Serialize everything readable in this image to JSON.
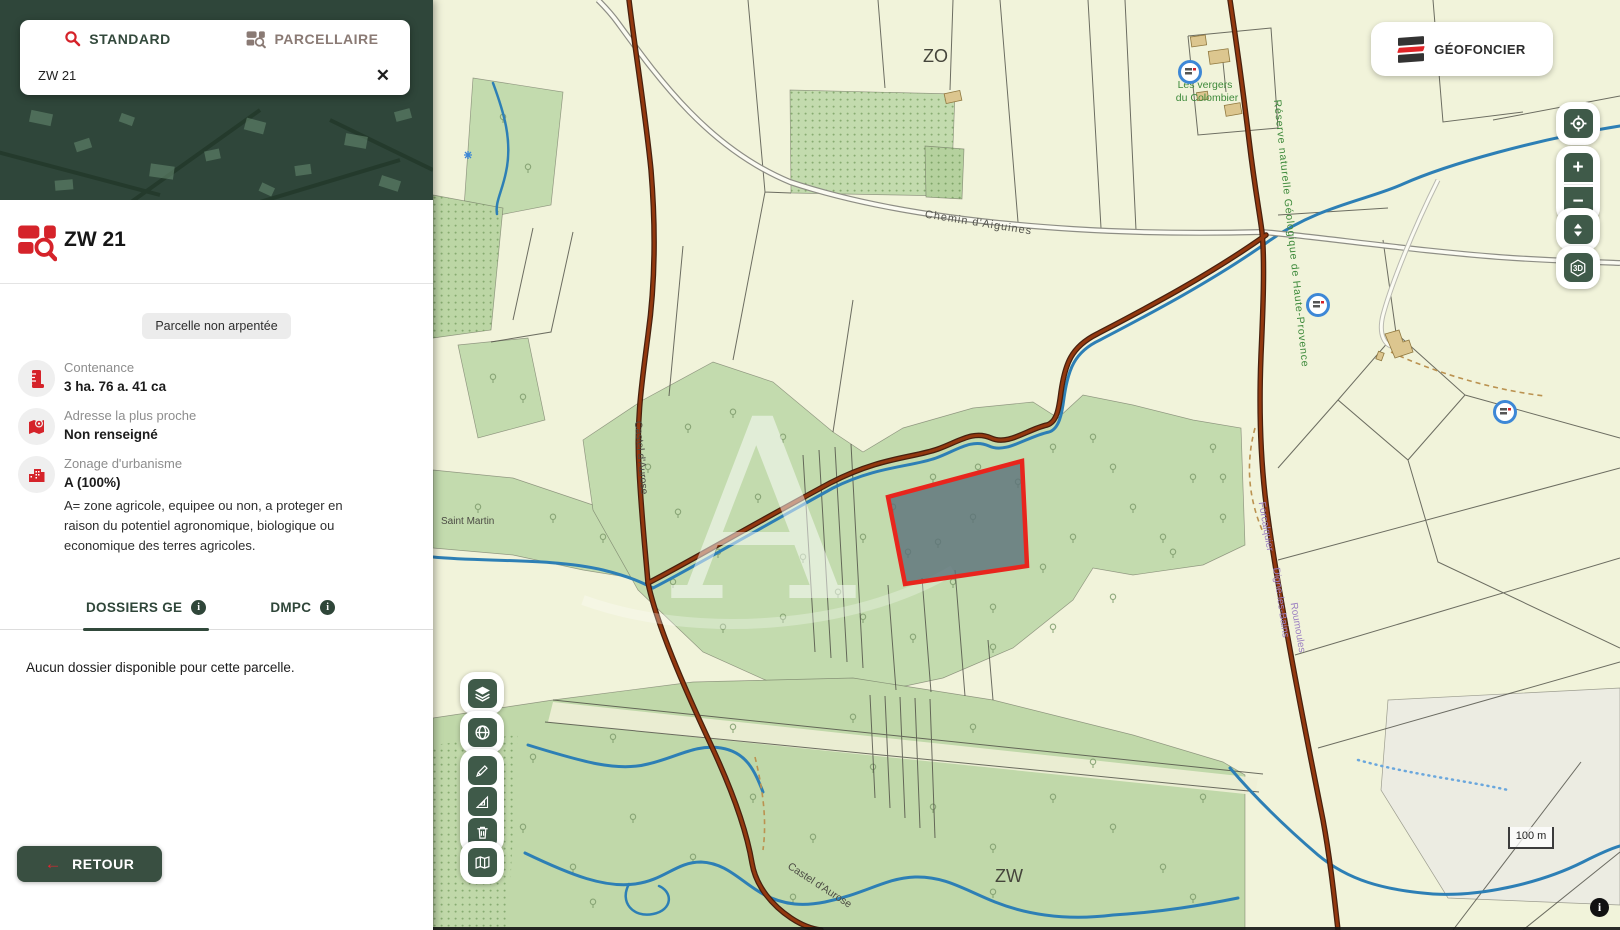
{
  "search": {
    "tabs": [
      {
        "label": "STANDARD"
      },
      {
        "label": "PARCELLAIRE"
      }
    ],
    "query": "ZW 21"
  },
  "brand": {
    "name": "GÉOFONCIER"
  },
  "parcel": {
    "title": "ZW 21",
    "badge": "Parcelle non arpentée",
    "fields": [
      {
        "icon": "ruler-icon",
        "label": "Contenance",
        "value": "3 ha. 76 a. 41 ca"
      },
      {
        "icon": "address-icon",
        "label": "Adresse la plus proche",
        "value": "Non renseigné"
      },
      {
        "icon": "urbanism-icon",
        "label": "Zonage d'urbanisme",
        "value": "A (100%)",
        "description": "A= zone agricole, equipee ou non, a proteger en raison du potentiel agronomique, biologique ou economique des terres agricoles."
      }
    ],
    "tabs": [
      {
        "label": "DOSSIERS GE"
      },
      {
        "label": "DMPC"
      }
    ],
    "tab_info_glyph": "i",
    "empty_message": "Aucun dossier disponible pour cette parcelle.",
    "back_label": "RETOUR",
    "back_arrow": "←"
  },
  "map": {
    "labels": {
      "zone_top": "ZO",
      "zone_bottom": "ZW",
      "road_chemin": "Chemin d'Aiguines",
      "road_castel_upper": "Castel d'Aurose",
      "road_castel_lower": "Castel d'Aurose",
      "hamlet": "Saint Martin",
      "place_line1": "Les vergers",
      "place_line2": "du Colombier",
      "reserve": "Réserve naturelle Géologique de Haute-Provence",
      "route_1": "Forcalquier",
      "route_2": "Digne-les-Bains",
      "route_3": "Roumoules",
      "watermark": "A"
    },
    "scale_label": "100 m",
    "controls": {
      "zoom_in": "+",
      "zoom_out": "−",
      "view_3d": "3D",
      "info": "i"
    }
  },
  "colors": {
    "accent_red": "#d5232a",
    "dark_green": "#394f41",
    "control_green": "#3f5a49",
    "map_background": "#f1f3da",
    "forest_green": "#c3dbae",
    "river_blue": "#2d7fb5",
    "road_brown": "#8c3510",
    "selected_parcel_fill": "#5b717a",
    "selected_parcel_stroke": "#e8251d",
    "map_label_green": "#3e8a3b",
    "map_label_purple": "#9b7fc1",
    "badge_background": "#ececec"
  }
}
